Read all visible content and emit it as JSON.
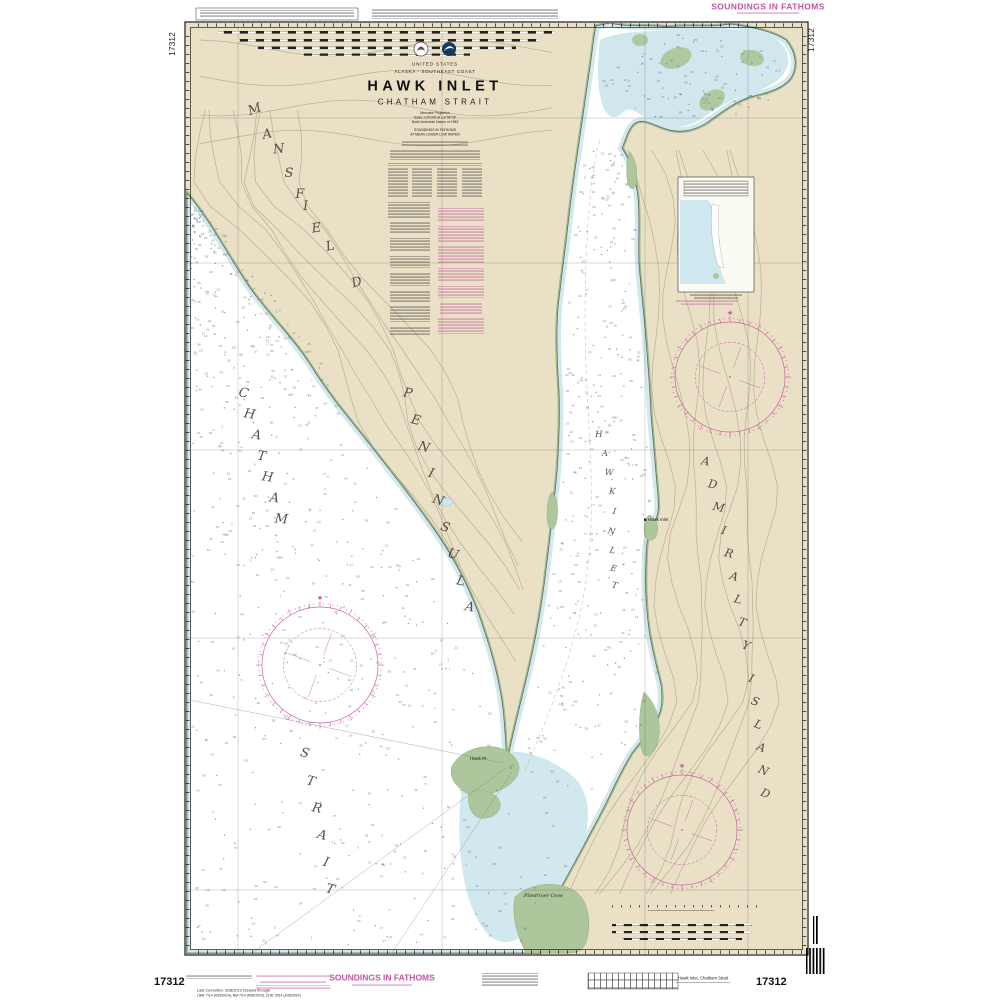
{
  "colors": {
    "land": "#e9e0c6",
    "water": "#ffffff",
    "shallow": "#cfe7ee",
    "marsh": "#aec69b",
    "magenta": "#c2569e",
    "contour": "#b6ab8e",
    "ink": "#1c1c1c"
  },
  "chart": {
    "number": "17312",
    "country": "UNITED STATES",
    "region": "ALASKA - SOUTHEAST COAST",
    "title": "HAWK INLET",
    "subtitle": "CHATHAM STRAIT",
    "projection_lines": [
      "Mercator Projection",
      "Scale 1:20,000 at Lat 58°05'",
      "North American Datum of 1983"
    ],
    "soundings_lines": [
      "SOUNDINGS IN FATHOMS",
      "AT MEAN LOWER LOW WATER"
    ]
  },
  "margin": {
    "banner_top": "SOUNDINGS IN FATHOMS",
    "banner_bottom": "SOUNDINGS IN FATHOMS",
    "caption": "Hawk Inlet, Chatham Strait",
    "last_correction": "Last Correction: 3/28/2013   Cleared through",
    "corrections_detail": "LNM: 7/14 (4/19/2014), NM 7/14 (4/26/2014), CHS: 2014 (3/28/2014)",
    "number_bottom_left": "17312",
    "number_bottom_right": "17312",
    "number_top_left": "17312",
    "number_top_right": "17312"
  },
  "map_labels": {
    "words": [
      "MANSFIELD",
      "PENINSULA",
      "CHATHAM",
      "STRAIT",
      "ADMIRALTY",
      "ISLAND",
      "HAWK",
      "INLET"
    ],
    "points": [
      "Hawk Inlet",
      "Hawk Pt",
      "Piledriver Cove"
    ]
  },
  "soundings_unit": "fathoms"
}
